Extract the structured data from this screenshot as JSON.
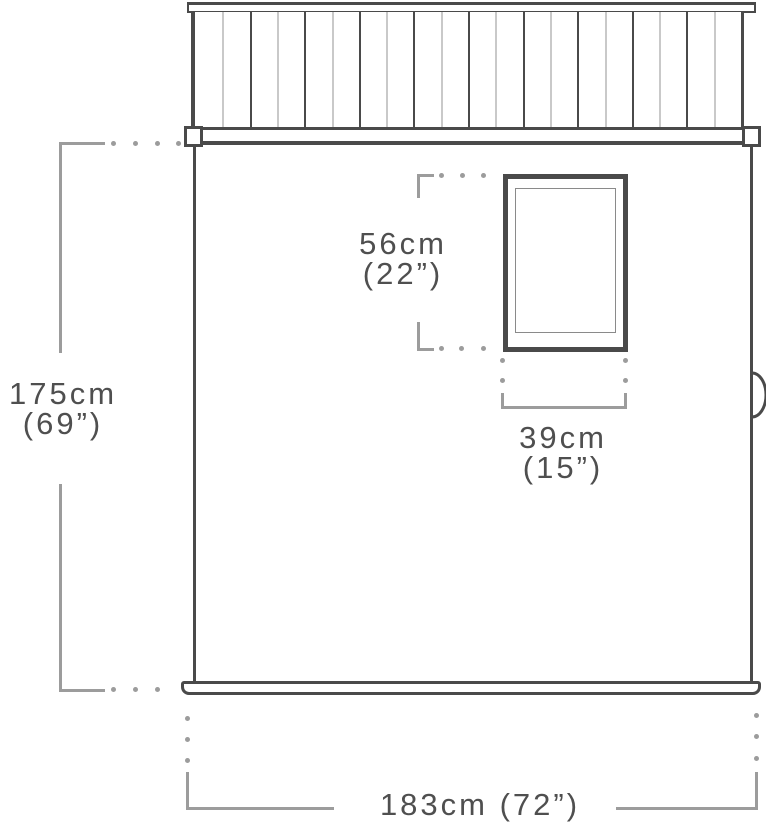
{
  "diagram": {
    "type": "product-dimension-diagram",
    "subject": "shed front elevation with slatted roof, window, side handle and overall dimensions",
    "colors": {
      "background": "#ffffff",
      "outline": "#4a4a4a",
      "slat_light": "#c9c9c9",
      "slat_dark": "#4a4a4a",
      "dimension_line": "#9c9c9c",
      "label_text": "#4f4f4f"
    },
    "roof": {
      "slat_count": 19
    },
    "labels": {
      "overall_height_cm": "175cm",
      "overall_height_in": "(69”)",
      "window_height_cm": "56cm",
      "window_height_in": "(22”)",
      "window_width_cm": "39cm",
      "window_width_in": "(15”)",
      "overall_width": "183cm (72”)"
    }
  }
}
